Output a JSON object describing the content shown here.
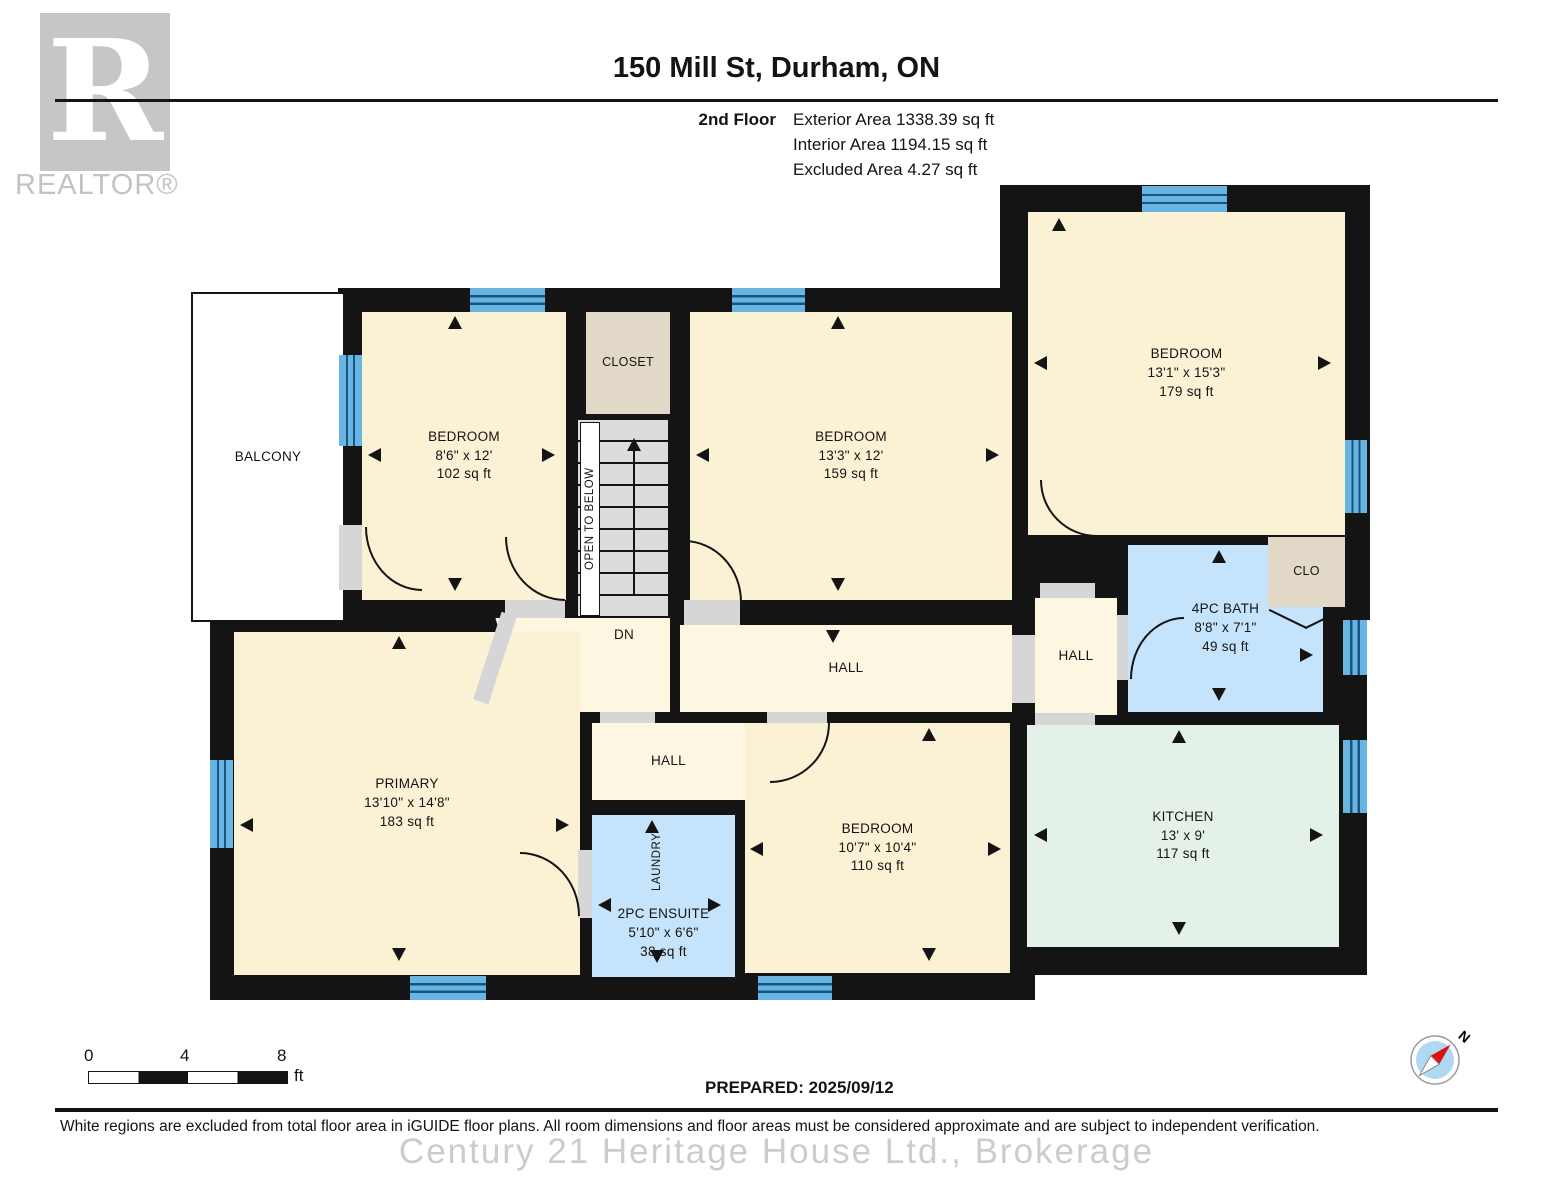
{
  "header": {
    "logo_letter": "R",
    "logo_text": "REALTOR®",
    "title": "150 Mill St, Durham, ON",
    "floor_label": "2nd Floor",
    "area_lines": [
      "Exterior Area 1338.39 sq ft",
      "Interior Area 1194.15 sq ft",
      "Excluded Area 4.27 sq ft"
    ]
  },
  "rooms": {
    "balcony": {
      "name": "BALCONY"
    },
    "bedroom_top_left": {
      "name": "BEDROOM",
      "dims": "8'6\" x 12'",
      "area": "102 sq ft"
    },
    "closet": {
      "name": "CLOSET"
    },
    "stairs": {
      "open_label": "OPEN TO BELOW",
      "down_label": "DN"
    },
    "bedroom_top_mid": {
      "name": "BEDROOM",
      "dims": "13'3\" x 12'",
      "area": "159 sq ft"
    },
    "bedroom_top_right": {
      "name": "BEDROOM",
      "dims": "13'1\" x 15'3\"",
      "area": "179 sq ft"
    },
    "clo": {
      "name": "CLO"
    },
    "bath": {
      "name": "4PC BATH",
      "dims": "8'8\" x 7'1\"",
      "area": "49 sq ft"
    },
    "hall_left": {
      "name": "HALL"
    },
    "hall_mid": {
      "name": "HALL"
    },
    "hall_right": {
      "name": "HALL"
    },
    "hall_small": {
      "name": "HALL"
    },
    "primary": {
      "name": "PRIMARY",
      "dims": "13'10\" x 14'8\"",
      "area": "183 sq ft"
    },
    "laundry": {
      "name": "LAUNDRY"
    },
    "ensuite": {
      "name": "2PC ENSUITE",
      "dims": "5'10\" x 6'6\"",
      "area": "38 sq ft"
    },
    "bedroom_bottom": {
      "name": "BEDROOM",
      "dims": "10'7\" x 10'4\"",
      "area": "110 sq ft"
    },
    "kitchen": {
      "name": "KITCHEN",
      "dims": "13' x 9'",
      "area": "117 sq ft"
    }
  },
  "footer": {
    "scale_ticks": {
      "t0": "0",
      "t4": "4",
      "t8": "8",
      "unit": "ft"
    },
    "prepared": "PREPARED: 2025/09/12",
    "compass_north": "N",
    "disclaimer": "White regions are excluded from total floor area in iGUIDE floor plans. All room dimensions and floor areas must be considered approximate and are subject to independent verification.",
    "watermark": "Century 21 Heritage House Ltd.,  Brokerage"
  },
  "colors": {
    "wall": "#141414",
    "room_cream": "#FBF1D4",
    "hall_cream": "#FDF6E1",
    "closet_tan": "#E2D8C7",
    "bath_blue": "#C5E3FA",
    "kitchen_mint": "#E4F1E9",
    "window_blue": "#68B4E3",
    "door_grey": "#D6D6D6",
    "logo_grey": "#C6C6C6"
  }
}
